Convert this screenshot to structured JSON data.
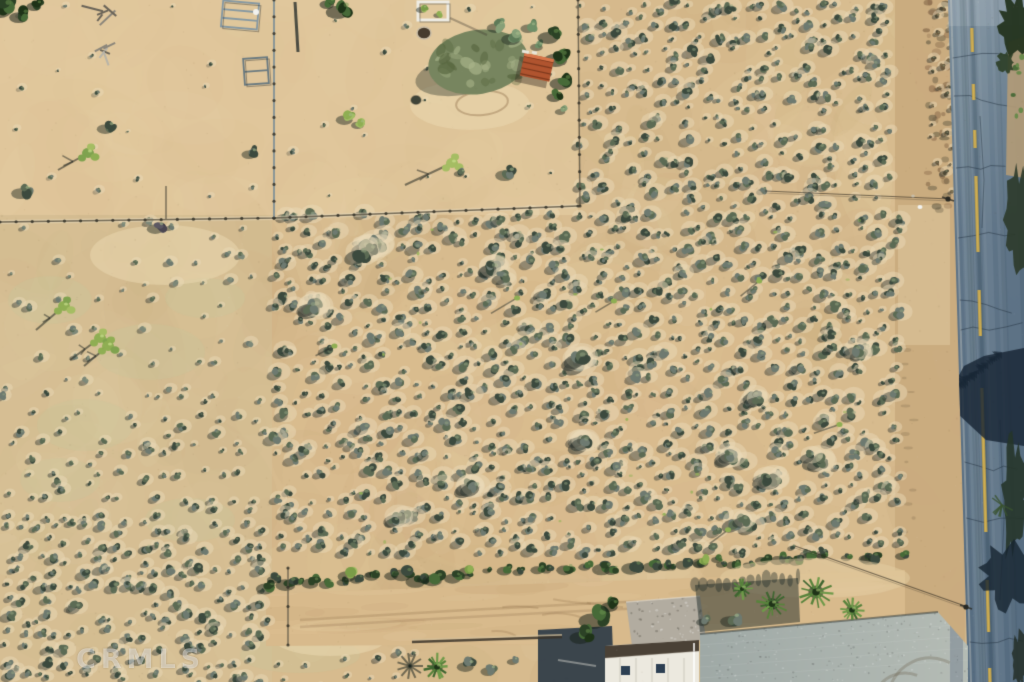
{
  "meta": {
    "type": "aerial-photograph",
    "description": "Overhead drone photo of a vacant desert scrub land parcel beside a paved road, with a fenced homestead at top and buildings along the bottom"
  },
  "watermark": {
    "text": "CRMLS",
    "color": "rgba(255,255,255,0.38)"
  },
  "palette": {
    "sandBase": "#d7bb8e",
    "sandLight": "#ecd9b1",
    "sandDark": "#c2a173",
    "paddockTint": "#e7cfa6",
    "leftTint": "#d5c79e",
    "grassTint": "#c6c69b",
    "shrubDark": "#3c4a3e",
    "shrubMid": "#5c6b54",
    "shrubLight": "#8a987c",
    "shrubGray": "#6e7a70",
    "brightGreen": "#8fae53",
    "treeDark": "#2c4226",
    "treeMid": "#476a38",
    "roadMid": "#64798b",
    "roadDark": "#4d6275",
    "roadShadow": "#23394d",
    "centerline": "#c6a447",
    "shoulder": "#c9ab7e",
    "slab": "#9fa9a6",
    "slabLight": "#b5bcb5",
    "gravel": "#b2aca0",
    "roofWhite": "#ece9df",
    "roofTrim": "#4a4136",
    "rustRoof": "#b0542f",
    "rustDark": "#7e3a1e",
    "fence": "#5f5848",
    "wire": "#3a352c",
    "white": "#f2f2ee"
  },
  "scene": {
    "seed": 1337,
    "zones": [
      {
        "rect": [
          0,
          0,
          578,
          215
        ],
        "fill": "#e7cfa6",
        "alpha": 0.55
      },
      {
        "rect": [
          0,
          215,
          272,
          467
        ],
        "fill": "#d5c79e",
        "alpha": 0.35
      },
      {
        "rect": [
          895,
          0,
          70,
          682
        ],
        "fill": "#c9ab7e",
        "alpha": 0.95
      },
      {
        "ellipse": [
          560,
          420,
          270,
          160
        ],
        "fill": "#e6c292",
        "alpha": 0.15
      },
      {
        "rect": [
          898,
          205,
          52,
          140
        ],
        "fill": "#e0c9a1",
        "alpha": 0.5
      }
    ],
    "grassPatches": [
      [
        50,
        300,
        42,
        24
      ],
      [
        150,
        352,
        55,
        28
      ],
      [
        85,
        425,
        48,
        26
      ],
      [
        205,
        298,
        40,
        20
      ],
      [
        60,
        480,
        40,
        22
      ],
      [
        190,
        520,
        45,
        22
      ],
      [
        300,
        655,
        60,
        18
      ]
    ],
    "dustPatches": [
      [
        165,
        255,
        75,
        30
      ],
      [
        470,
        105,
        60,
        25
      ],
      [
        330,
        640,
        55,
        16
      ]
    ],
    "dirtBand": {
      "poly": [
        [
          266,
          594
        ],
        [
          905,
          570
        ],
        [
          905,
          642
        ],
        [
          266,
          646
        ]
      ]
    },
    "shrubRegions": [
      {
        "rect": [
          578,
          0,
          318,
          208
        ],
        "step": 15,
        "r": [
          2.5,
          7.5
        ],
        "skip": 0.18
      },
      {
        "rect": [
          272,
          210,
          624,
          352
        ],
        "step": 15,
        "r": [
          2.5,
          8
        ],
        "skip": 0.18
      },
      {
        "rect": [
          0,
          216,
          272,
          175
        ],
        "step": 26,
        "r": [
          2,
          5.5
        ],
        "skip": 0.32,
        "gray": true
      },
      {
        "rect": [
          0,
          391,
          272,
          130
        ],
        "step": 19,
        "r": [
          2.5,
          6
        ],
        "skip": 0.25
      },
      {
        "rect": [
          0,
          521,
          272,
          161
        ],
        "step": 15,
        "r": [
          3,
          7.5
        ],
        "skip": 0.18
      },
      {
        "rect": [
          0,
          0,
          575,
          205
        ],
        "step": 40,
        "r": [
          1.5,
          4
        ],
        "skip": 0.5,
        "shAlpha": 0.25
      },
      {
        "rect": [
          272,
          648,
          150,
          34
        ],
        "step": 22,
        "r": [
          2,
          5
        ],
        "skip": 0.3
      },
      {
        "rect": [
          928,
          0,
          22,
          205
        ],
        "step": 13,
        "r": [
          2,
          4.5
        ],
        "skip": 0.25,
        "brush": true
      }
    ],
    "bigClumps": {
      "rect": [
        300,
        230,
        560,
        300
      ],
      "n": 14
    },
    "accents": {
      "rect": [
        280,
        215,
        620,
        340
      ],
      "n": 22,
      "color": "#93b156"
    },
    "jtScatter": {
      "rect": [
        320,
        240,
        540,
        290
      ],
      "n": 6
    },
    "hedge": {
      "from": [
        268,
        582
      ],
      "to": [
        902,
        553
      ],
      "n": 52,
      "bright": [
        [
          352,
          573,
          9
        ],
        [
          470,
          569,
          7
        ],
        [
          705,
          560,
          8
        ]
      ]
    },
    "road": {
      "leftTop": 948,
      "leftBottom": 968,
      "centerTop": 971,
      "centerBottom": 990,
      "dashes": [
        [
          28,
          52
        ],
        [
          84,
          100
        ],
        [
          130,
          148
        ],
        [
          176,
          252
        ],
        [
          290,
          336
        ],
        [
          388,
          532
        ],
        [
          580,
          632
        ],
        [
          668,
          694
        ]
      ],
      "crackYs": [
        58,
        96,
        168,
        238,
        300,
        330,
        462,
        518,
        642
      ],
      "tanStrip": [
        [
          1008,
          42
        ],
        [
          1024,
          36
        ],
        [
          1024,
          178
        ],
        [
          1006,
          175
        ]
      ],
      "bigShadow": [
        [
          950,
          392
        ],
        [
          964,
          366
        ],
        [
          984,
          356
        ],
        [
          1024,
          348
        ],
        [
          1024,
          446
        ],
        [
          986,
          440
        ],
        [
          958,
          414
        ]
      ]
    },
    "fences": [
      {
        "pts": [
          [
            0,
            222
          ],
          [
            274,
            218
          ],
          [
            578,
            206
          ]
        ],
        "light": true,
        "posts": true
      },
      {
        "pts": [
          [
            274,
            0
          ],
          [
            274,
            218
          ]
        ],
        "posts": true,
        "steel": true
      },
      {
        "pts": [
          [
            578,
            0
          ],
          [
            580,
            206
          ]
        ],
        "posts": true
      },
      {
        "pts": [
          [
            166,
            186
          ],
          [
            166,
            219
          ]
        ]
      },
      {
        "pts": [
          [
            288,
            568
          ],
          [
            288,
            645
          ]
        ],
        "posts": true
      }
    ],
    "wires": [
      {
        "pts": [
          [
            765,
            191
          ],
          [
            950,
            199
          ]
        ],
        "pole": [
          948,
          199
        ]
      },
      {
        "pts": [
          [
            795,
            546
          ],
          [
            965,
            606
          ]
        ],
        "pole": [
          966,
          607
        ]
      }
    ],
    "features": [
      {
        "op": "shadowPoly",
        "poly": [
          [
            538,
            630
          ],
          [
            612,
            626
          ],
          [
            614,
            682
          ],
          [
            538,
            682
          ]
        ],
        "fill": "#2e3b47",
        "alpha": 0.92
      },
      {
        "op": "line",
        "pts": [
          [
            558,
            660
          ],
          [
            596,
            666
          ]
        ],
        "w": 2,
        "c": "rgba(205,205,198,0.5)"
      },
      {
        "op": "pad",
        "poly": [
          [
            626,
            602
          ],
          [
            700,
            596
          ],
          [
            706,
            640
          ],
          [
            632,
            646
          ]
        ]
      },
      {
        "op": "clump",
        "x": 600,
        "y": 616,
        "r": 13,
        "dark": true
      },
      {
        "op": "clump",
        "x": 586,
        "y": 634,
        "r": 10,
        "dark": true
      },
      {
        "op": "clump",
        "x": 614,
        "y": 604,
        "r": 8,
        "dark": true
      },
      {
        "op": "building"
      },
      {
        "op": "slab"
      },
      {
        "op": "mound",
        "x": 815,
        "y": 578,
        "rx": 95,
        "ry": 20
      },
      {
        "op": "shadowPoly",
        "poly": [
          [
            695,
            585
          ],
          [
            798,
            578
          ],
          [
            800,
            622
          ],
          [
            700,
            632
          ]
        ],
        "fill": "#1e2a28",
        "alpha": 0.5,
        "fringe": true
      },
      {
        "op": "palm",
        "x": 772,
        "y": 604,
        "r": 15
      },
      {
        "op": "palm",
        "x": 816,
        "y": 592,
        "r": 17
      },
      {
        "op": "palm",
        "x": 852,
        "y": 610,
        "r": 13
      },
      {
        "op": "palm",
        "x": 742,
        "y": 589,
        "r": 10
      },
      {
        "op": "clump",
        "x": 735,
        "y": 618,
        "r": 9
      },
      {
        "op": "clump",
        "x": 706,
        "y": 620,
        "r": 6
      },
      {
        "op": "wall",
        "pts": [
          [
            412,
            642
          ],
          [
            562,
            637
          ]
        ]
      },
      {
        "op": "palmShadow",
        "x": 410,
        "y": 666,
        "r": 13
      },
      {
        "op": "palm",
        "x": 437,
        "y": 667,
        "r": 13
      },
      {
        "op": "clump",
        "x": 470,
        "y": 664,
        "r": 8
      },
      {
        "op": "clump",
        "x": 492,
        "y": 669,
        "r": 7
      },
      {
        "op": "clump",
        "x": 515,
        "y": 660,
        "r": 5
      },
      {
        "op": "frame",
        "x": 222,
        "y": 2,
        "w": 36,
        "h": 26,
        "rot": 5,
        "c": "#8598a2",
        "bars": 2
      },
      {
        "op": "frame",
        "x": 244,
        "y": 58,
        "w": 24,
        "h": 26,
        "rot": -4,
        "c": "#6a7a80",
        "bars": 1
      },
      {
        "op": "line",
        "pts": [
          [
            295,
            2
          ],
          [
            298,
            52
          ]
        ],
        "w": 3,
        "c": "rgba(50,55,50,0.85)"
      },
      {
        "op": "dot",
        "x": 256,
        "y": 12,
        "r": 3,
        "c": "#f2f2ee"
      },
      {
        "op": "frame",
        "x": 418,
        "y": 2,
        "w": 30,
        "h": 18,
        "rot": 0,
        "c": "#efede4",
        "bars": 0,
        "thick": 3
      },
      {
        "op": "clump",
        "x": 424,
        "y": 8,
        "r": 5,
        "bright": true
      },
      {
        "op": "clump",
        "x": 440,
        "y": 14,
        "r": 4,
        "bright": true
      },
      {
        "op": "disc",
        "x": 424,
        "y": 33,
        "r": 7,
        "fill": "#473c2e",
        "stroke": "#c9bda6"
      },
      {
        "op": "ellipseStroke",
        "x": 482,
        "y": 103,
        "rx": 26,
        "ry": 12,
        "rot": -6,
        "c": "rgba(150,120,85,0.45)"
      },
      {
        "op": "sageTree",
        "x": 478,
        "y": 62,
        "rx": 50,
        "ry": 32
      },
      {
        "op": "clump",
        "x": 500,
        "y": 25,
        "r": 8,
        "cactus": true
      },
      {
        "op": "clump",
        "x": 516,
        "y": 36,
        "r": 9,
        "cactus": true
      },
      {
        "op": "clump",
        "x": 532,
        "y": 26,
        "r": 7,
        "cactus": true
      },
      {
        "op": "clump",
        "x": 540,
        "y": 45,
        "r": 6,
        "cactus": true
      },
      {
        "op": "clump",
        "x": 554,
        "y": 34,
        "r": 10,
        "dark": true
      },
      {
        "op": "clump",
        "x": 562,
        "y": 56,
        "r": 11,
        "dark": true
      },
      {
        "op": "clump",
        "x": 566,
        "y": 80,
        "r": 10,
        "dark": true
      },
      {
        "op": "clump",
        "x": 558,
        "y": 95,
        "r": 7,
        "dark": true
      },
      {
        "op": "shed"
      },
      {
        "op": "clump",
        "x": 563,
        "y": 110,
        "r": 5,
        "cactus": true
      },
      {
        "op": "jt",
        "x": 452,
        "y": 163,
        "sx": 405,
        "sy": 185
      },
      {
        "op": "clump",
        "x": 462,
        "y": 172,
        "r": 5
      },
      {
        "op": "clump",
        "x": 510,
        "y": 172,
        "r": 9
      },
      {
        "op": "clump",
        "x": 349,
        "y": 117,
        "r": 8,
        "bright": true
      },
      {
        "op": "clump",
        "x": 361,
        "y": 123,
        "r": 6,
        "bright": true
      },
      {
        "op": "clump",
        "x": 344,
        "y": 8,
        "r": 11,
        "dark": true
      },
      {
        "op": "clump",
        "x": 331,
        "y": 2,
        "r": 7,
        "dark": true
      },
      {
        "op": "line",
        "pts": [
          [
            450,
            18
          ],
          [
            487,
            35
          ]
        ],
        "w": 2,
        "c": "rgba(60,55,45,0.35)"
      },
      {
        "op": "disc",
        "x": 416,
        "y": 100,
        "r": 5,
        "fill": "#3f4438",
        "stroke": "rgba(60,60,50,0.4)"
      },
      {
        "op": "clump",
        "x": 6,
        "y": 6,
        "r": 12,
        "dark": true
      },
      {
        "op": "clump",
        "x": 24,
        "y": 14,
        "r": 9,
        "dark": true
      },
      {
        "op": "clump",
        "x": 38,
        "y": 4,
        "r": 7,
        "dark": true
      },
      {
        "op": "debris",
        "x": 108,
        "y": 10
      },
      {
        "op": "debris",
        "x": 108,
        "y": 48
      },
      {
        "op": "jt",
        "x": 88,
        "y": 153,
        "sx": 58,
        "sy": 170
      },
      {
        "op": "clump",
        "x": 110,
        "y": 126,
        "r": 8
      },
      {
        "op": "clump",
        "x": 26,
        "y": 190,
        "r": 9
      },
      {
        "op": "clump",
        "x": 253,
        "y": 152,
        "r": 7
      },
      {
        "op": "clump",
        "x": 160,
        "y": 226,
        "r": 8,
        "purple": true
      },
      {
        "op": "jt",
        "x": 64,
        "y": 306,
        "sx": 36,
        "sy": 330
      },
      {
        "op": "jt",
        "x": 100,
        "y": 338,
        "sx": 70,
        "sy": 360
      },
      {
        "op": "jt",
        "x": 108,
        "y": 346,
        "sx": 84,
        "sy": 366
      }
    ],
    "semanticRegions": {
      "paved-road": [
        948,
        0,
        76,
        682
      ],
      "road-shoulder": [
        895,
        0,
        53,
        682
      ],
      "scrub-parcel-main": [
        270,
        210,
        640,
        352
      ],
      "scrub-top-right": [
        578,
        0,
        320,
        210
      ],
      "fenced-paddock": [
        0,
        0,
        578,
        215
      ],
      "left-field": [
        0,
        215,
        272,
        467
      ],
      "hedge-row": [
        268,
        548,
        640,
        40
      ],
      "dirt-road": [
        266,
        568,
        640,
        75
      ],
      "corral-gate": [
        220,
        0,
        80,
        85
      ],
      "planter-box": [
        414,
        0,
        36,
        24
      ],
      "shed": [
        520,
        50,
        36,
        36
      ],
      "house-roof": [
        605,
        640,
        94,
        42
      ],
      "gravel-pad": [
        626,
        596,
        80,
        50
      ],
      "concrete-slab": [
        695,
        610,
        273,
        72
      ],
      "palm-grove": [
        730,
        578,
        135,
        52
      ]
    }
  }
}
